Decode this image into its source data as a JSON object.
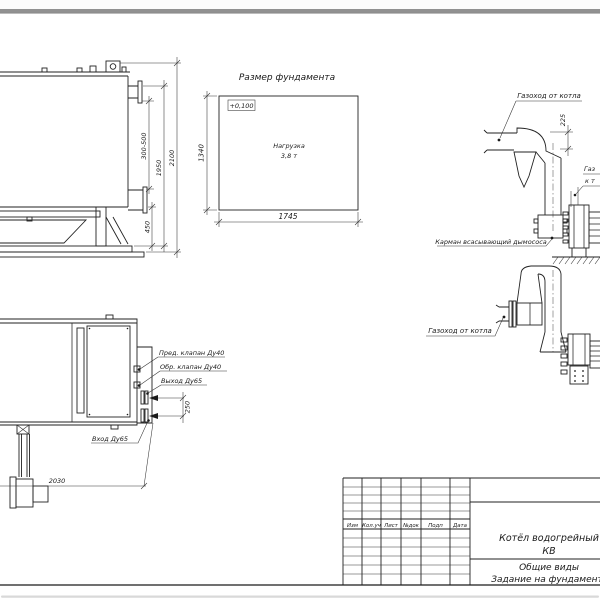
{
  "window": {
    "top_edge_color": "#919191",
    "paper_color": "#ffffff",
    "ink_color": "#1a1a1a"
  },
  "side_view": {
    "dim_flange_range": "300-500",
    "dim_height_flange": "1950",
    "dim_height_total": "2100",
    "dim_base": "450"
  },
  "foundation_plan": {
    "title": "Размер фундамента",
    "level_mark": "+0,100",
    "load_line1": "Нагрузка",
    "load_line2": "3,8 т",
    "dim_height": "1340",
    "dim_width": "1745"
  },
  "flue_elevation": {
    "duct_label": "Газоход от котла",
    "dim_duct": "225",
    "pocket_label": "Карман всасывающий дымососа",
    "clipped_label_line1": "Газ",
    "clipped_label_line2": "к т"
  },
  "flue_plan": {
    "duct_label": "Газоход от котла"
  },
  "boiler_plan": {
    "safety_valve_label": "Пред. клапан Ду40",
    "check_valve_label": "Обр. клапан Ду40",
    "outlet_label": "Выход Ду65",
    "inlet_label": "Вход Ду65",
    "dim_ports": "250",
    "dim_length": "2030"
  },
  "title_block": {
    "headers": [
      "Изм",
      "Кол.уч",
      "Лист",
      "№док",
      "Подп",
      "Дата"
    ],
    "doc_title_line1": "Котёл водогрейный",
    "doc_title_line2": "КВ",
    "view_title": "Общие виды",
    "task_title": "Задание на фундамент"
  }
}
